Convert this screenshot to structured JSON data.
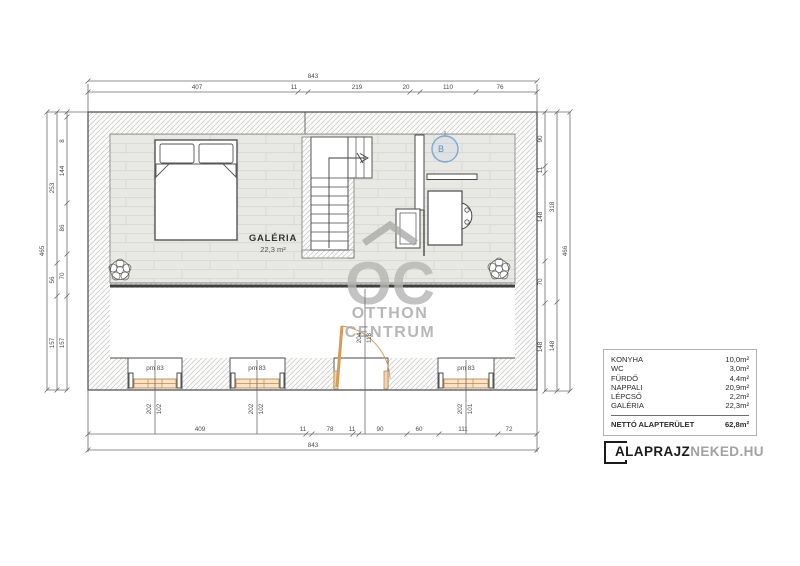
{
  "colors": {
    "outline": "#4a4a4a",
    "hatch": "#c7c7c7",
    "floor": "#e8e8e5",
    "window_accent": "#c08b4f",
    "door_accent": "#d79b55",
    "boiler_blue": "#6f9fd0",
    "watermark_gray": "#ababab",
    "dim_text": "#4a4a4a"
  },
  "plan": {
    "room_label": "GALÉRIA",
    "room_area": "22,3 m²",
    "boiler_label": "B"
  },
  "windows": [
    {
      "label": "pm 83",
      "dims": [
        "202",
        "102"
      ]
    },
    {
      "label": "pm 83",
      "dims": [
        "202",
        "102"
      ]
    },
    {
      "label": "pm 83",
      "dims": [
        "202",
        "101"
      ]
    }
  ],
  "door": {
    "dims": [
      "204",
      "118"
    ]
  },
  "dims": {
    "top_total": "843",
    "top_segments": [
      "407",
      "11",
      "219",
      "20",
      "110",
      "76"
    ],
    "bottom_segments": [
      "409",
      "11",
      "78",
      "11",
      "90",
      "60",
      "111",
      "72"
    ],
    "bottom_total": "843",
    "left_outer_total": "465",
    "left_middle": [
      "253",
      "56",
      "157"
    ],
    "left_inner": [
      "8",
      "144",
      "86",
      "70",
      "157"
    ],
    "right_inner": [
      "90",
      "11",
      "148",
      "70",
      "148"
    ],
    "right_middle": [
      "318",
      "148"
    ],
    "right_outer_total": "466"
  },
  "watermark": {
    "mark": "OC",
    "line1": "OTTHON",
    "line2": "CENTRUM"
  },
  "area_table": {
    "rows": [
      {
        "label": "KONYHA",
        "value": "10,0m²"
      },
      {
        "label": "WC",
        "value": "3,0m²"
      },
      {
        "label": "FÜRDŐ",
        "value": "4,4m²"
      },
      {
        "label": "NAPPALI",
        "value": "20,9m²"
      },
      {
        "label": "LÉPCSŐ",
        "value": "2,2m²"
      },
      {
        "label": "GALÉRIA",
        "value": "22,3m²"
      }
    ],
    "total_label": "NETTÓ ALAPTERÜLET",
    "total_value": "62,8m²"
  },
  "logo": {
    "bold": "ALAPRAJZ",
    "light": "NEKED.HU"
  }
}
